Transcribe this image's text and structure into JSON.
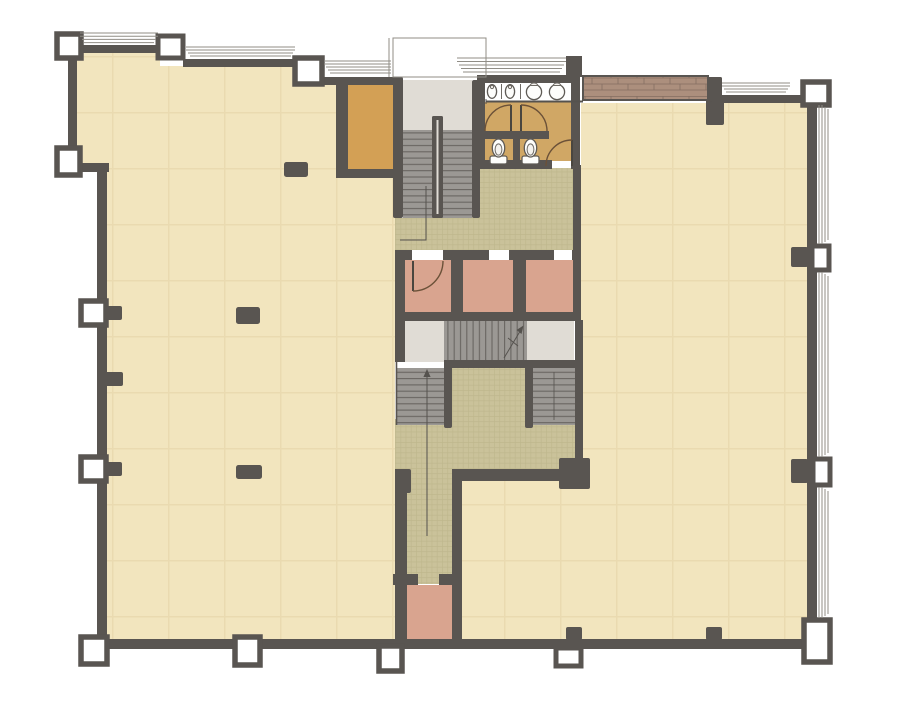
{
  "drawing": {
    "kind": "architectural-floor-plan",
    "view": "office floor plate with central service core",
    "background": "#ffffff"
  },
  "colors": {
    "wall": "#595551",
    "thin": "#908d86",
    "annot": "#55524e",
    "cream": "#F2E5BE",
    "creamLine": "#E7D7AB",
    "green": "#CAC29A",
    "greenLine": "#BCB48A",
    "pink": "#D9A48F",
    "orange": "#D3A055",
    "bath": "#D0A765",
    "landing": "#E0DCD5",
    "tread": "#9B9894",
    "treadLine": "#696561",
    "wood": "#AC8F7D",
    "woodLine": "#846E61",
    "white": "#ffffff"
  },
  "rooms": [
    {
      "id": "left-hall",
      "fill": "cream"
    },
    {
      "id": "right-hall",
      "fill": "cream"
    },
    {
      "id": "entry-vestibule",
      "fill": "landing"
    },
    {
      "id": "store-room",
      "fill": "orange"
    },
    {
      "id": "restroom",
      "fill": "bath"
    },
    {
      "id": "core-corridor",
      "fill": "green"
    },
    {
      "id": "elevator-shaft-1",
      "fill": "pink"
    },
    {
      "id": "elevator-shaft-2",
      "fill": "pink"
    },
    {
      "id": "elevator-shaft-3",
      "fill": "pink"
    },
    {
      "id": "core-lobby",
      "fill": "green"
    },
    {
      "id": "south-corridor",
      "fill": "green"
    },
    {
      "id": "south-shaft-room",
      "fill": "pink"
    }
  ],
  "stairs": [
    {
      "id": "north-stair",
      "treads": 14,
      "direction": "down-from-entry"
    },
    {
      "id": "central-scissor-stair",
      "treads": 13,
      "runs": 3
    }
  ],
  "fixtures": {
    "urinals": 2,
    "sinks": 2,
    "toilets": 2,
    "toilet-stalls": 2,
    "swing-doors": 4
  },
  "structure": {
    "hollow-columns": 13,
    "wall-piers": 9,
    "freestanding-piers": 4,
    "window-bays-top": 5,
    "window-bays-right": 3,
    "bench-top-right": 1,
    "entry-canopy": 1
  }
}
